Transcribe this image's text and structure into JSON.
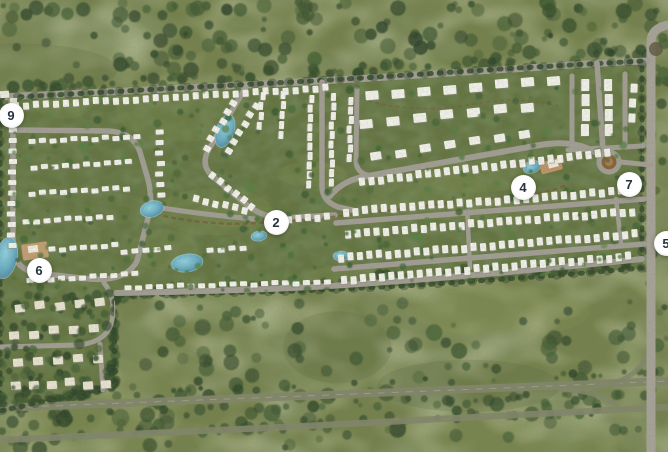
{
  "map": {
    "description": "Aerial master plan of a residential community surrounded by green fields and roads",
    "markers": [
      {
        "label": "2",
        "x": 276,
        "y": 222
      },
      {
        "label": "4",
        "x": 523,
        "y": 187
      },
      {
        "label": "5",
        "x": 666,
        "y": 243
      },
      {
        "label": "6",
        "x": 39,
        "y": 270
      },
      {
        "label": "7",
        "x": 629,
        "y": 184
      },
      {
        "label": "9",
        "x": 11,
        "y": 115
      }
    ],
    "palette": {
      "marker_bg": "#ffffff",
      "marker_text": "#26323e",
      "field_green": "#75814d",
      "field_patch_dark": "#55663c",
      "dev_green": "#647441",
      "tree_dark": "#344b2b",
      "road_gray": "#a39e95",
      "highway_olive": "#83866c",
      "house_white": "#f4f3ed",
      "house_cream": "#eae4d4",
      "water_teal": "#5ea8bf",
      "sand_tan": "#c59e73",
      "trail_brown": "#7b5a39"
    }
  }
}
